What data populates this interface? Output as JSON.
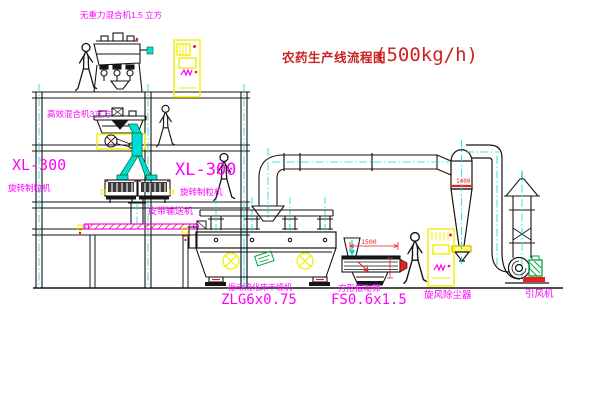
{
  "title": {
    "text": "农药生产线流程图",
    "capacity": "(500kg/h)"
  },
  "labels": {
    "gravity_free_mixer": "无重力混合机1.5 立方",
    "high_efficiency_mixer": "高效混合机3立方",
    "granulator_left_model": "XL-300",
    "granulator_left_name": "旋转制粒机",
    "granulator_mid_model": "XL-300",
    "granulator_mid_name": "旋转制粒机",
    "belt_conveyor": "皮带输送机",
    "dryer_name": "振动流化床干燥机",
    "dryer_model": "ZLG6x0.75",
    "sieve_name": "方形振动筛",
    "sieve_model": "FS0.6x1.5",
    "cyclone": "旋风除尘器",
    "fan": "引风机"
  },
  "dimensions": {
    "sieve_length": "1500",
    "cyclone_band": "1400"
  },
  "colors": {
    "background": "#ffffff",
    "line": "#151515",
    "label_magenta": "#ff00ff",
    "title_red": "#cc2222",
    "machine_yellow": "#f0f000",
    "centerline_cyan": "#00dcdc",
    "alert_red": "#e82020",
    "motor_green": "#00a33a"
  }
}
